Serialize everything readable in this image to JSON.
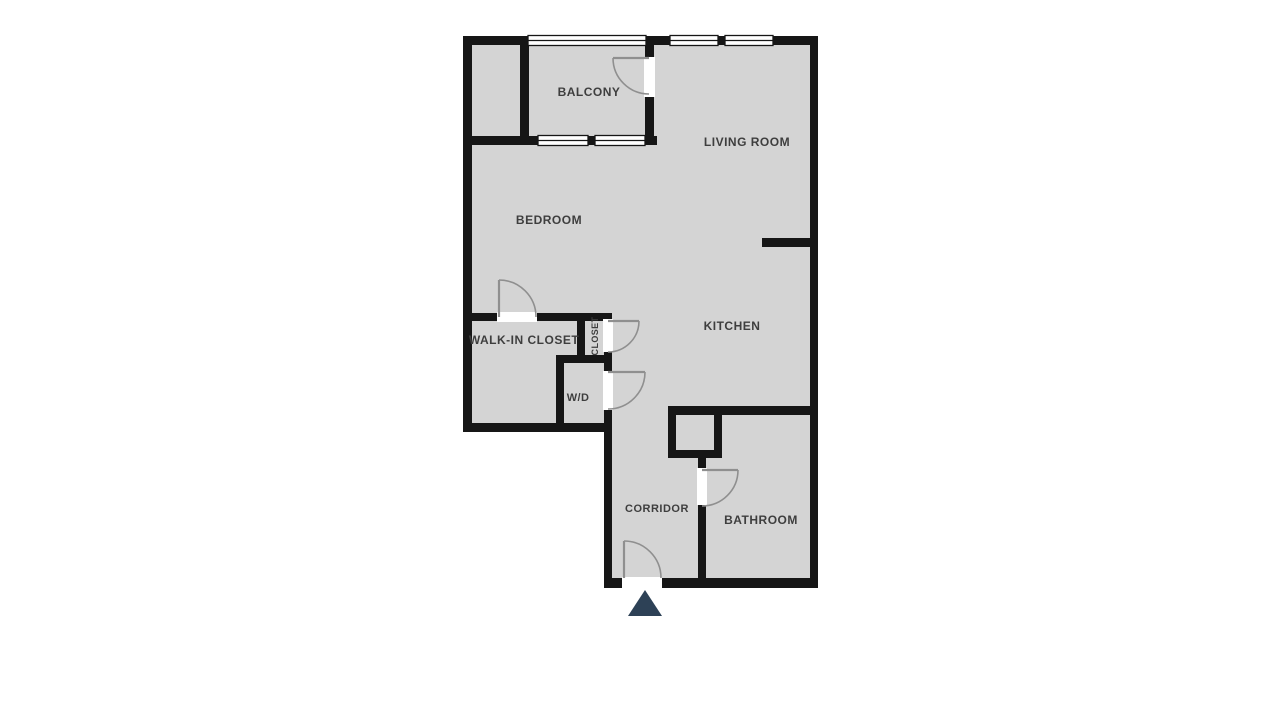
{
  "plan": {
    "type": "apartment-floor-plan",
    "background": "#ffffff"
  },
  "colors": {
    "floor": "#d4d4d4",
    "wall": "#161616",
    "label": "#3e3e3e",
    "door_swing": "#8f8f8f",
    "window_fill": "#ffffff",
    "entry_marker": "#2d4156"
  },
  "rooms": {
    "balcony": {
      "label": "BALCONY"
    },
    "living_room": {
      "label": "LIVING ROOM"
    },
    "bedroom": {
      "label": "BEDROOM"
    },
    "walk_in_closet": {
      "label": "WALK-IN CLOSET"
    },
    "closet": {
      "label": "CLOSET"
    },
    "wd": {
      "label": "W/D"
    },
    "kitchen": {
      "label": "KITCHEN"
    },
    "corridor": {
      "label": "CORRIDOR"
    },
    "bathroom": {
      "label": "BATHROOM"
    }
  },
  "markers": {
    "entry": "entry-arrow"
  }
}
